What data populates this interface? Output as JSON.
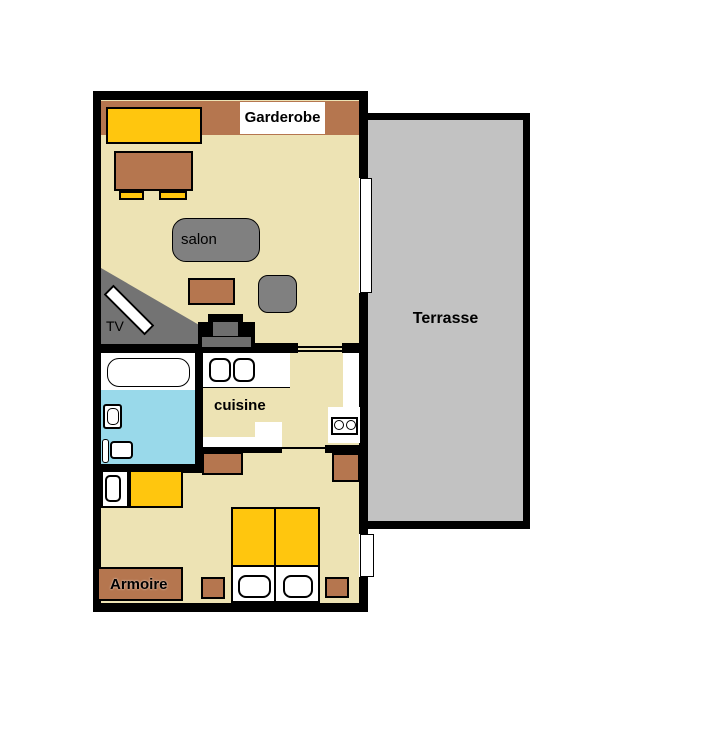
{
  "labels": {
    "garderobe": "Garderobe",
    "salon": "salon",
    "tv": "TV",
    "cuisine": "cuisine",
    "armoire": "Armoire",
    "terrasse": "Terrasse"
  },
  "colors": {
    "wall": "#000000",
    "floor": "#EDE3B4",
    "wood": "#B5764F",
    "yellow": "#FFC60E",
    "bath_floor": "#99D9EA",
    "terrace": "#C2C2C2",
    "gray_furniture": "#808080",
    "tv_corner": "#737373",
    "stove_gray": "#6E6E6E",
    "window": "#FFFFFF"
  }
}
